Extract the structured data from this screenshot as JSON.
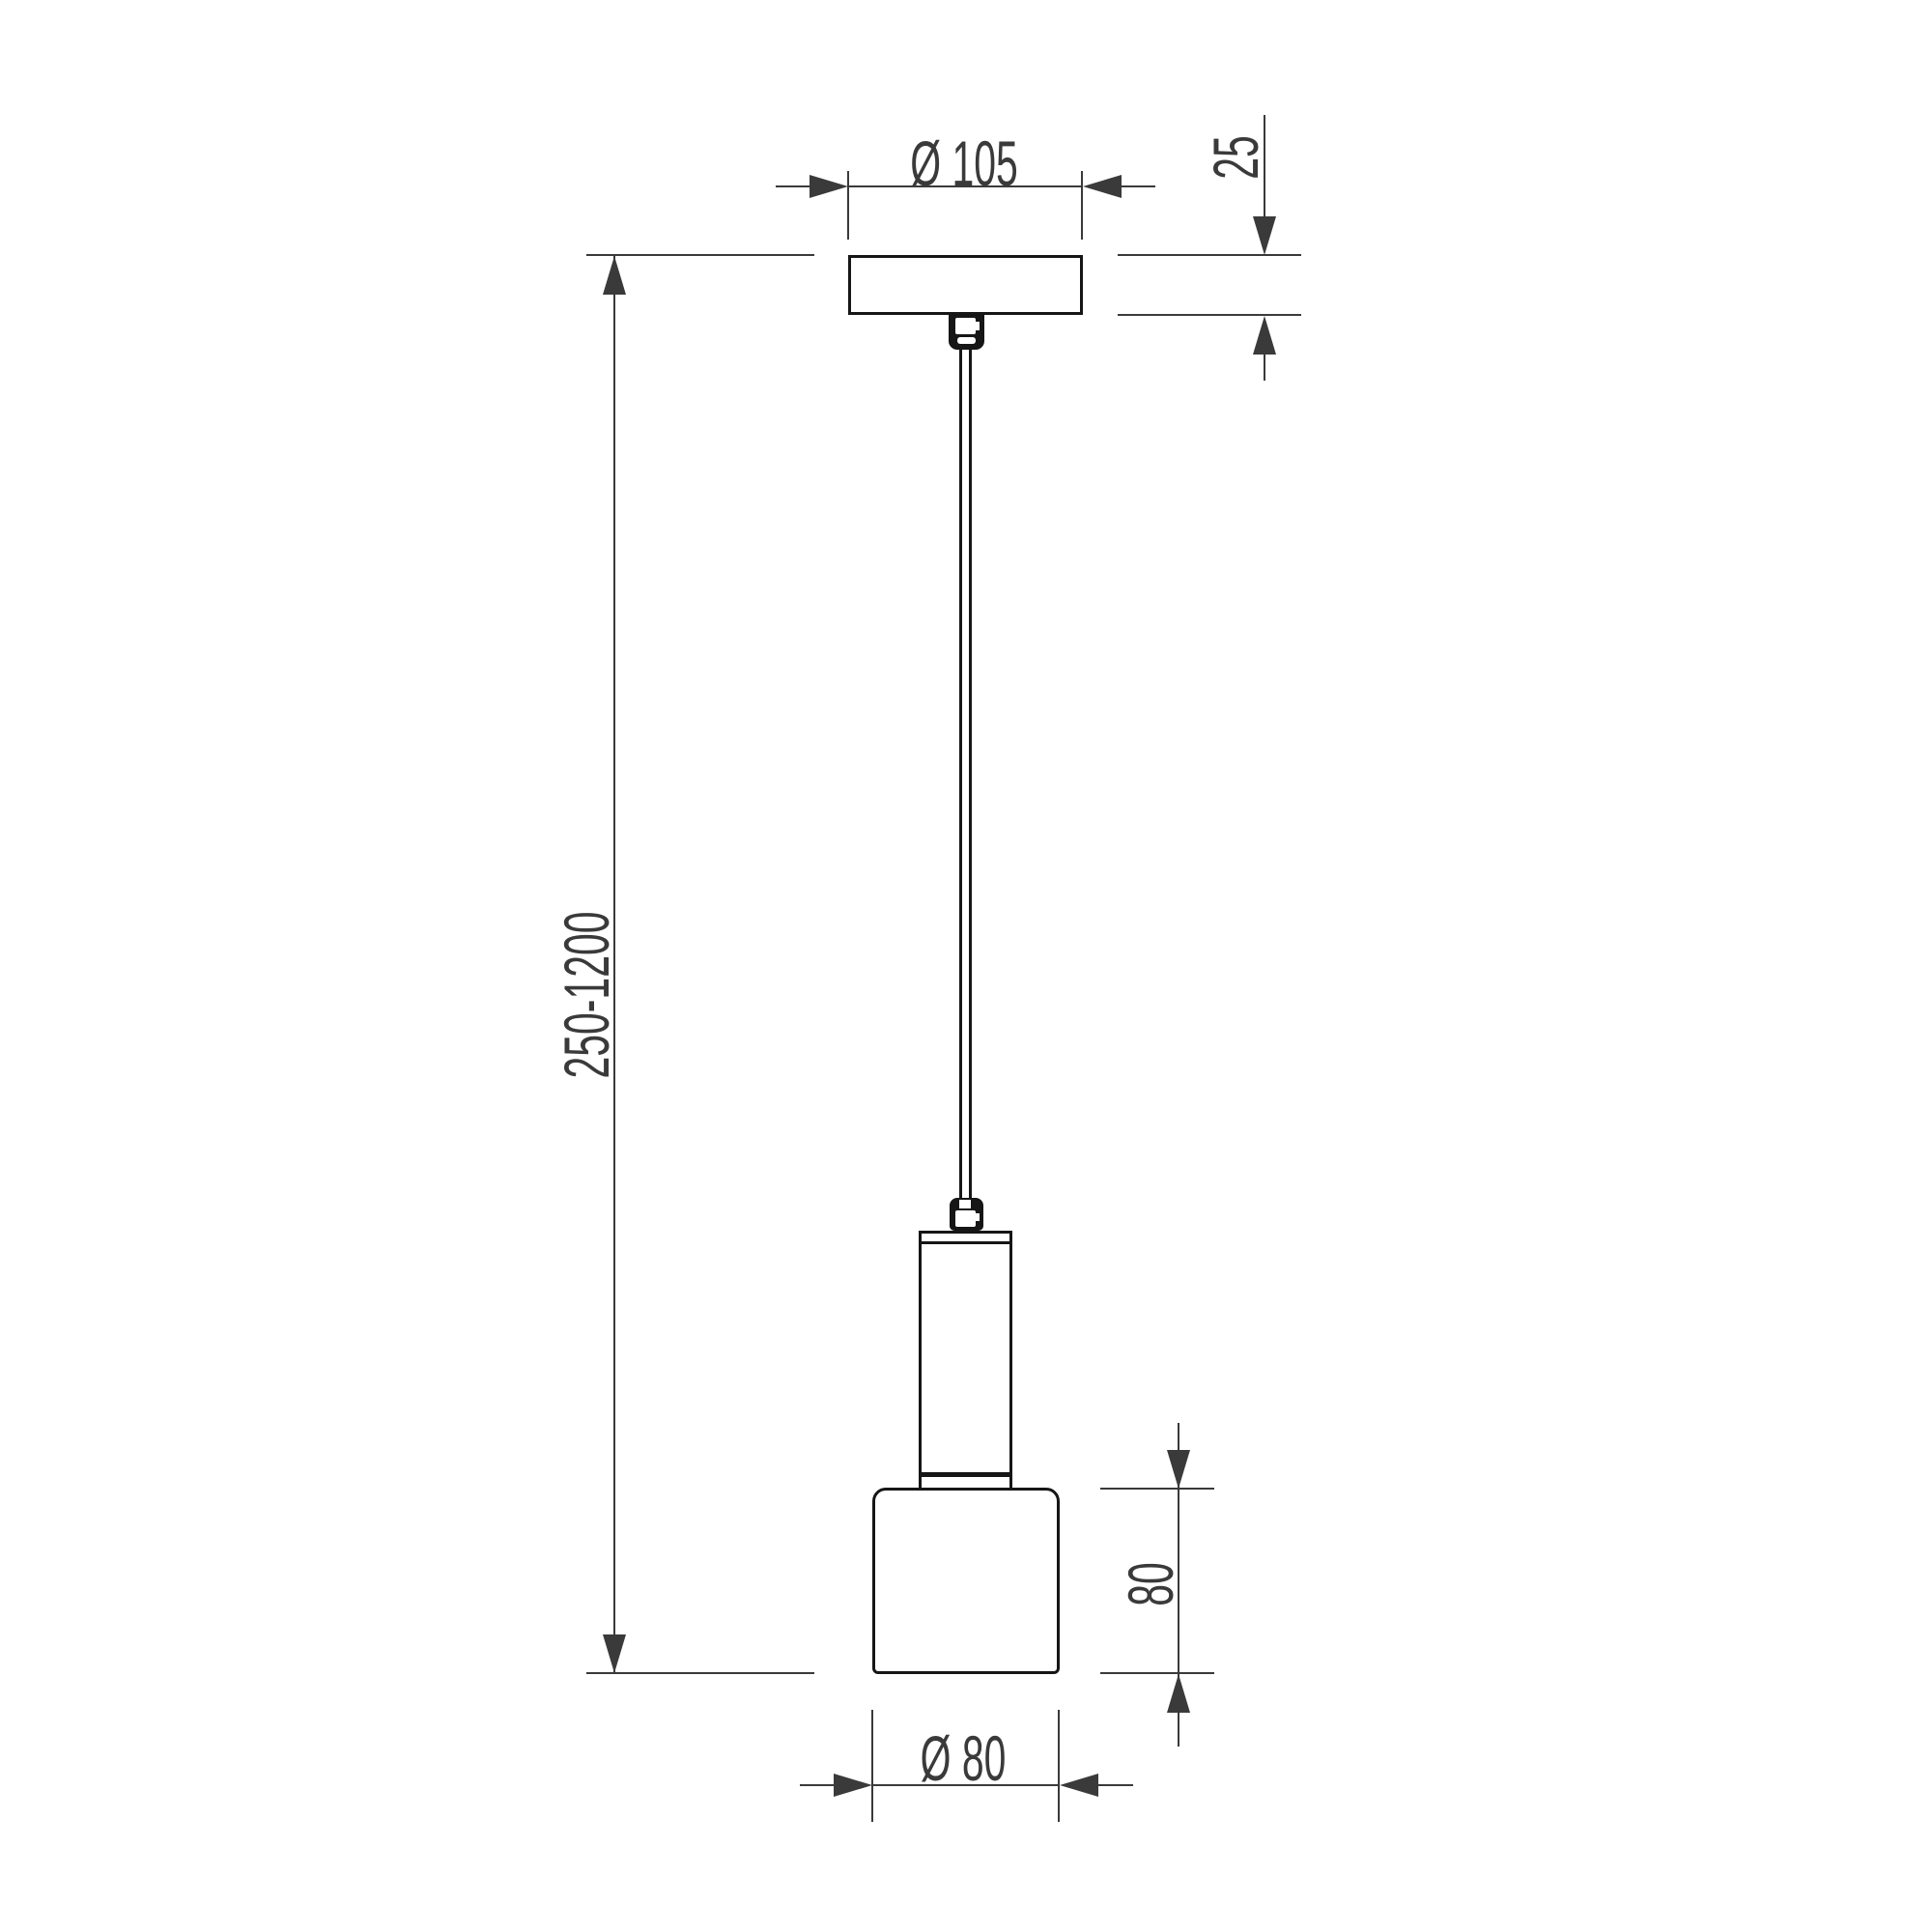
{
  "drawing": {
    "kind": "technical dimension drawing",
    "subject": "single pendant lamp, front elevation",
    "colors": {
      "background": "#ffffff",
      "object_line": "#161616",
      "dimension_line": "#3a3a3a",
      "text": "#3a3a3a"
    },
    "parts": [
      "ceiling-canopy",
      "cable-gland-canopy",
      "suspension-cable",
      "cable-gland-lamp",
      "lamp-stem",
      "lamp-shade"
    ],
    "dimensions": {
      "canopy_diameter": {
        "label": "Ø 105",
        "orientation": "horizontal"
      },
      "canopy_height": {
        "label": "25",
        "orientation": "vertical"
      },
      "suspension_length": {
        "label": "250-1200",
        "orientation": "vertical"
      },
      "shade_height": {
        "label": "80",
        "orientation": "vertical"
      },
      "shade_diameter": {
        "label": "Ø 80",
        "orientation": "horizontal"
      }
    }
  }
}
